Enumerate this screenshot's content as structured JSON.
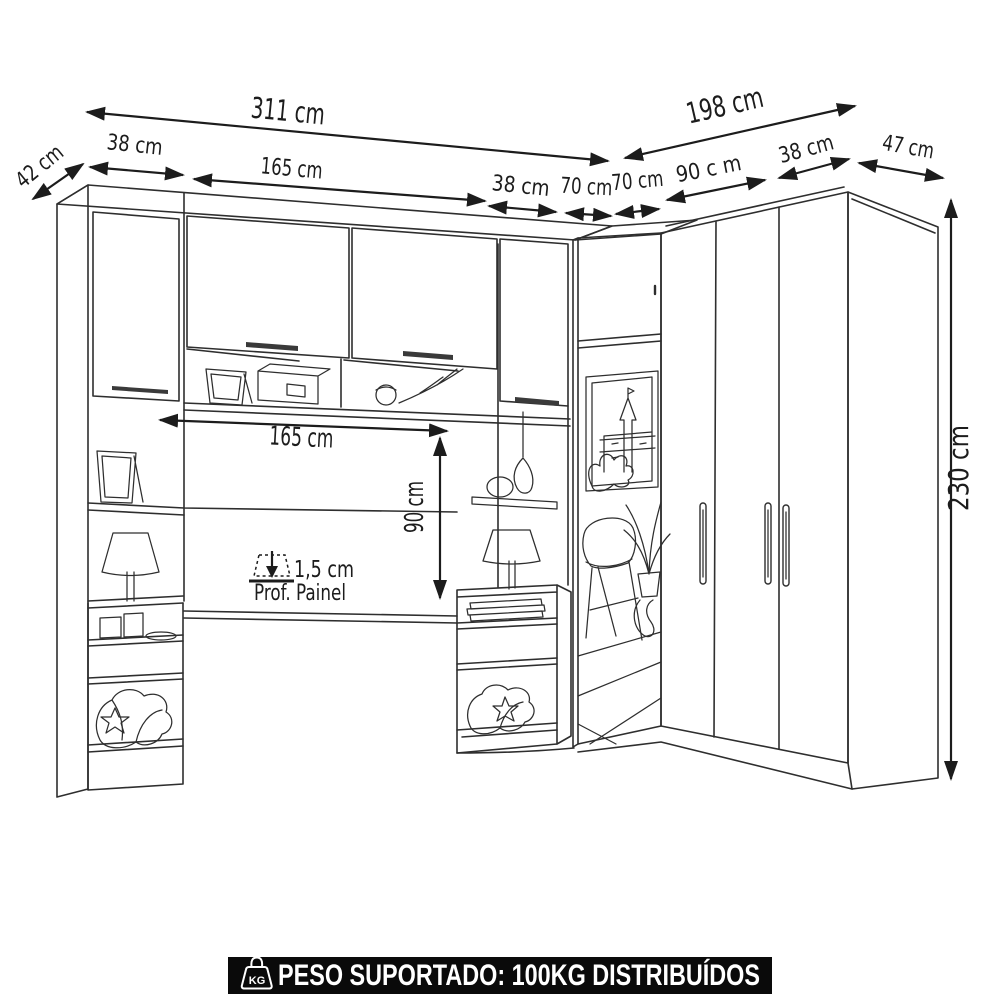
{
  "diagram": {
    "dimensions": {
      "total_left": "311 cm",
      "total_right": "198 cm",
      "depth_left": "42 cm",
      "left_tower": "38 cm",
      "bridge_top": "165 cm",
      "right_tower": "38 cm",
      "corner_left": "70 cm",
      "corner_right": "70 cm",
      "wardrobe_doors": "90 c m",
      "wardrobe_right_module": "38 cm",
      "depth_right": "47 cm",
      "height": "230 cm",
      "bridge_inner": "165 cm",
      "headboard_height": "90 cm",
      "panel_thickness": "1,5 cm",
      "panel_caption": "Prof. Painel"
    }
  },
  "banner": {
    "icon_label": "KG",
    "text": "PESO SUPORTADO: 100KG DISTRIBUÍDOS"
  },
  "colors": {
    "background": "#ffffff",
    "line": "#2e2e2e",
    "dimension": "#1c1c1c",
    "banner_bg": "#0a0a0a",
    "banner_text": "#ffffff"
  }
}
